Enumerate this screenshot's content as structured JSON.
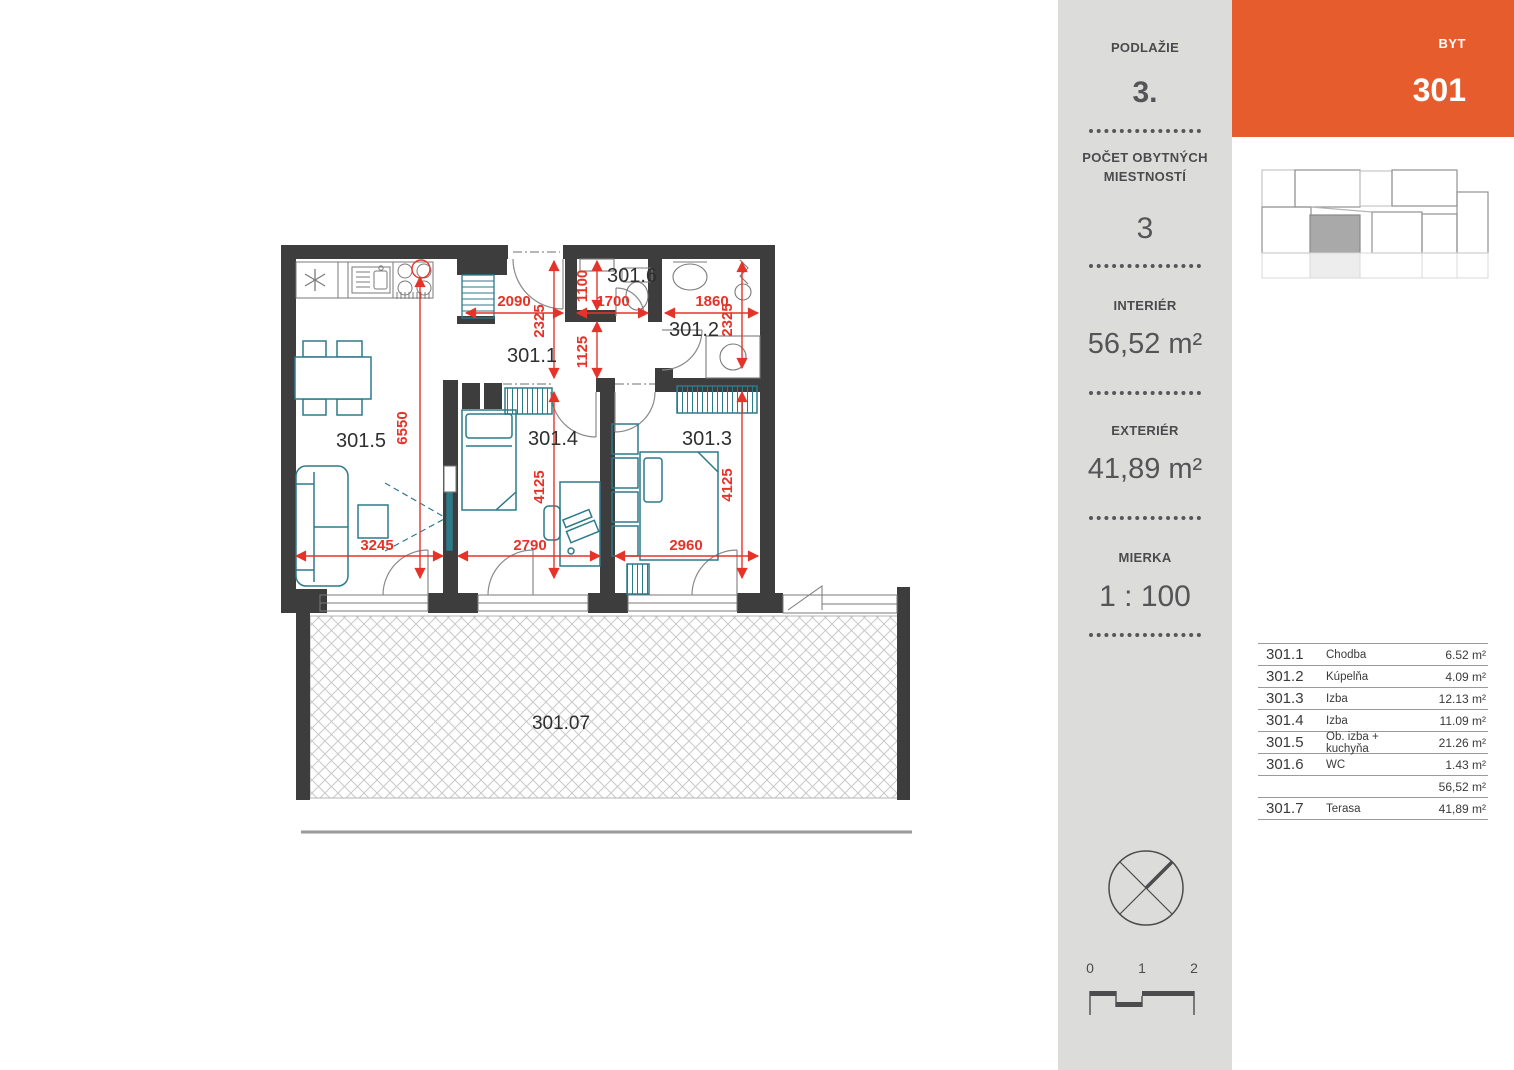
{
  "header": {
    "byt_label": "BYT",
    "byt_value": "301"
  },
  "sidebar": {
    "podlazie_label": "PODLAŽIE",
    "podlazie_value": "3.",
    "rooms_label_line1": "POČET OBYTNÝCH",
    "rooms_label_line2": "MIESTNOSTÍ",
    "rooms_value": "3",
    "interier_label": "INTERIÉR",
    "interier_value": "56,52 m²",
    "exterier_label": "EXTERIÉR",
    "exterier_value": "41,89 m²",
    "mierka_label": "MIERKA",
    "mierka_value": "1 : 100",
    "scale_ticks": [
      "0",
      "1",
      "2"
    ]
  },
  "room_table": {
    "rows": [
      {
        "number": "301.1",
        "name": "Chodba",
        "area": "6.52 m²"
      },
      {
        "number": "301.2",
        "name": "Kúpelňa",
        "area": "4.09 m²"
      },
      {
        "number": "301.3",
        "name": "Izba",
        "area": "12.13 m²"
      },
      {
        "number": "301.4",
        "name": "Izba",
        "area": "11.09 m²"
      },
      {
        "number": "301.5",
        "name": "Ob. izba + kuchyňa",
        "area": "21.26 m²"
      },
      {
        "number": "301.6",
        "name": "WC",
        "area": "1.43 m²"
      },
      {
        "number": "",
        "name": "",
        "area": "56,52 m²"
      },
      {
        "number": "301.7",
        "name": "Terasa",
        "area": "41,89 m²"
      }
    ]
  },
  "plan": {
    "labels": {
      "hall": "301.1",
      "bath": "301.2",
      "room3": "301.3",
      "room4": "301.4",
      "living": "301.5",
      "wc": "301.6",
      "terrace": "301.07"
    },
    "dims": {
      "hall_w": "2090",
      "wc_w": "1700",
      "bath_w": "1860",
      "wc_h": "1100",
      "hall_n_h": "2325",
      "hall_s_h": "1125",
      "bath_h": "2325",
      "living_h": "6550",
      "r4_h": "4125",
      "r3_h": "4125",
      "living_w": "3245",
      "r4_w": "2790",
      "r3_w": "2960"
    }
  },
  "colors": {
    "accent_orange": "#e65c2d",
    "dimension_red": "#e6332a",
    "furniture_teal": "#2b7a8a",
    "wall_dark": "#3d3d3d",
    "sidebar_gray": "#dcdcdb"
  }
}
